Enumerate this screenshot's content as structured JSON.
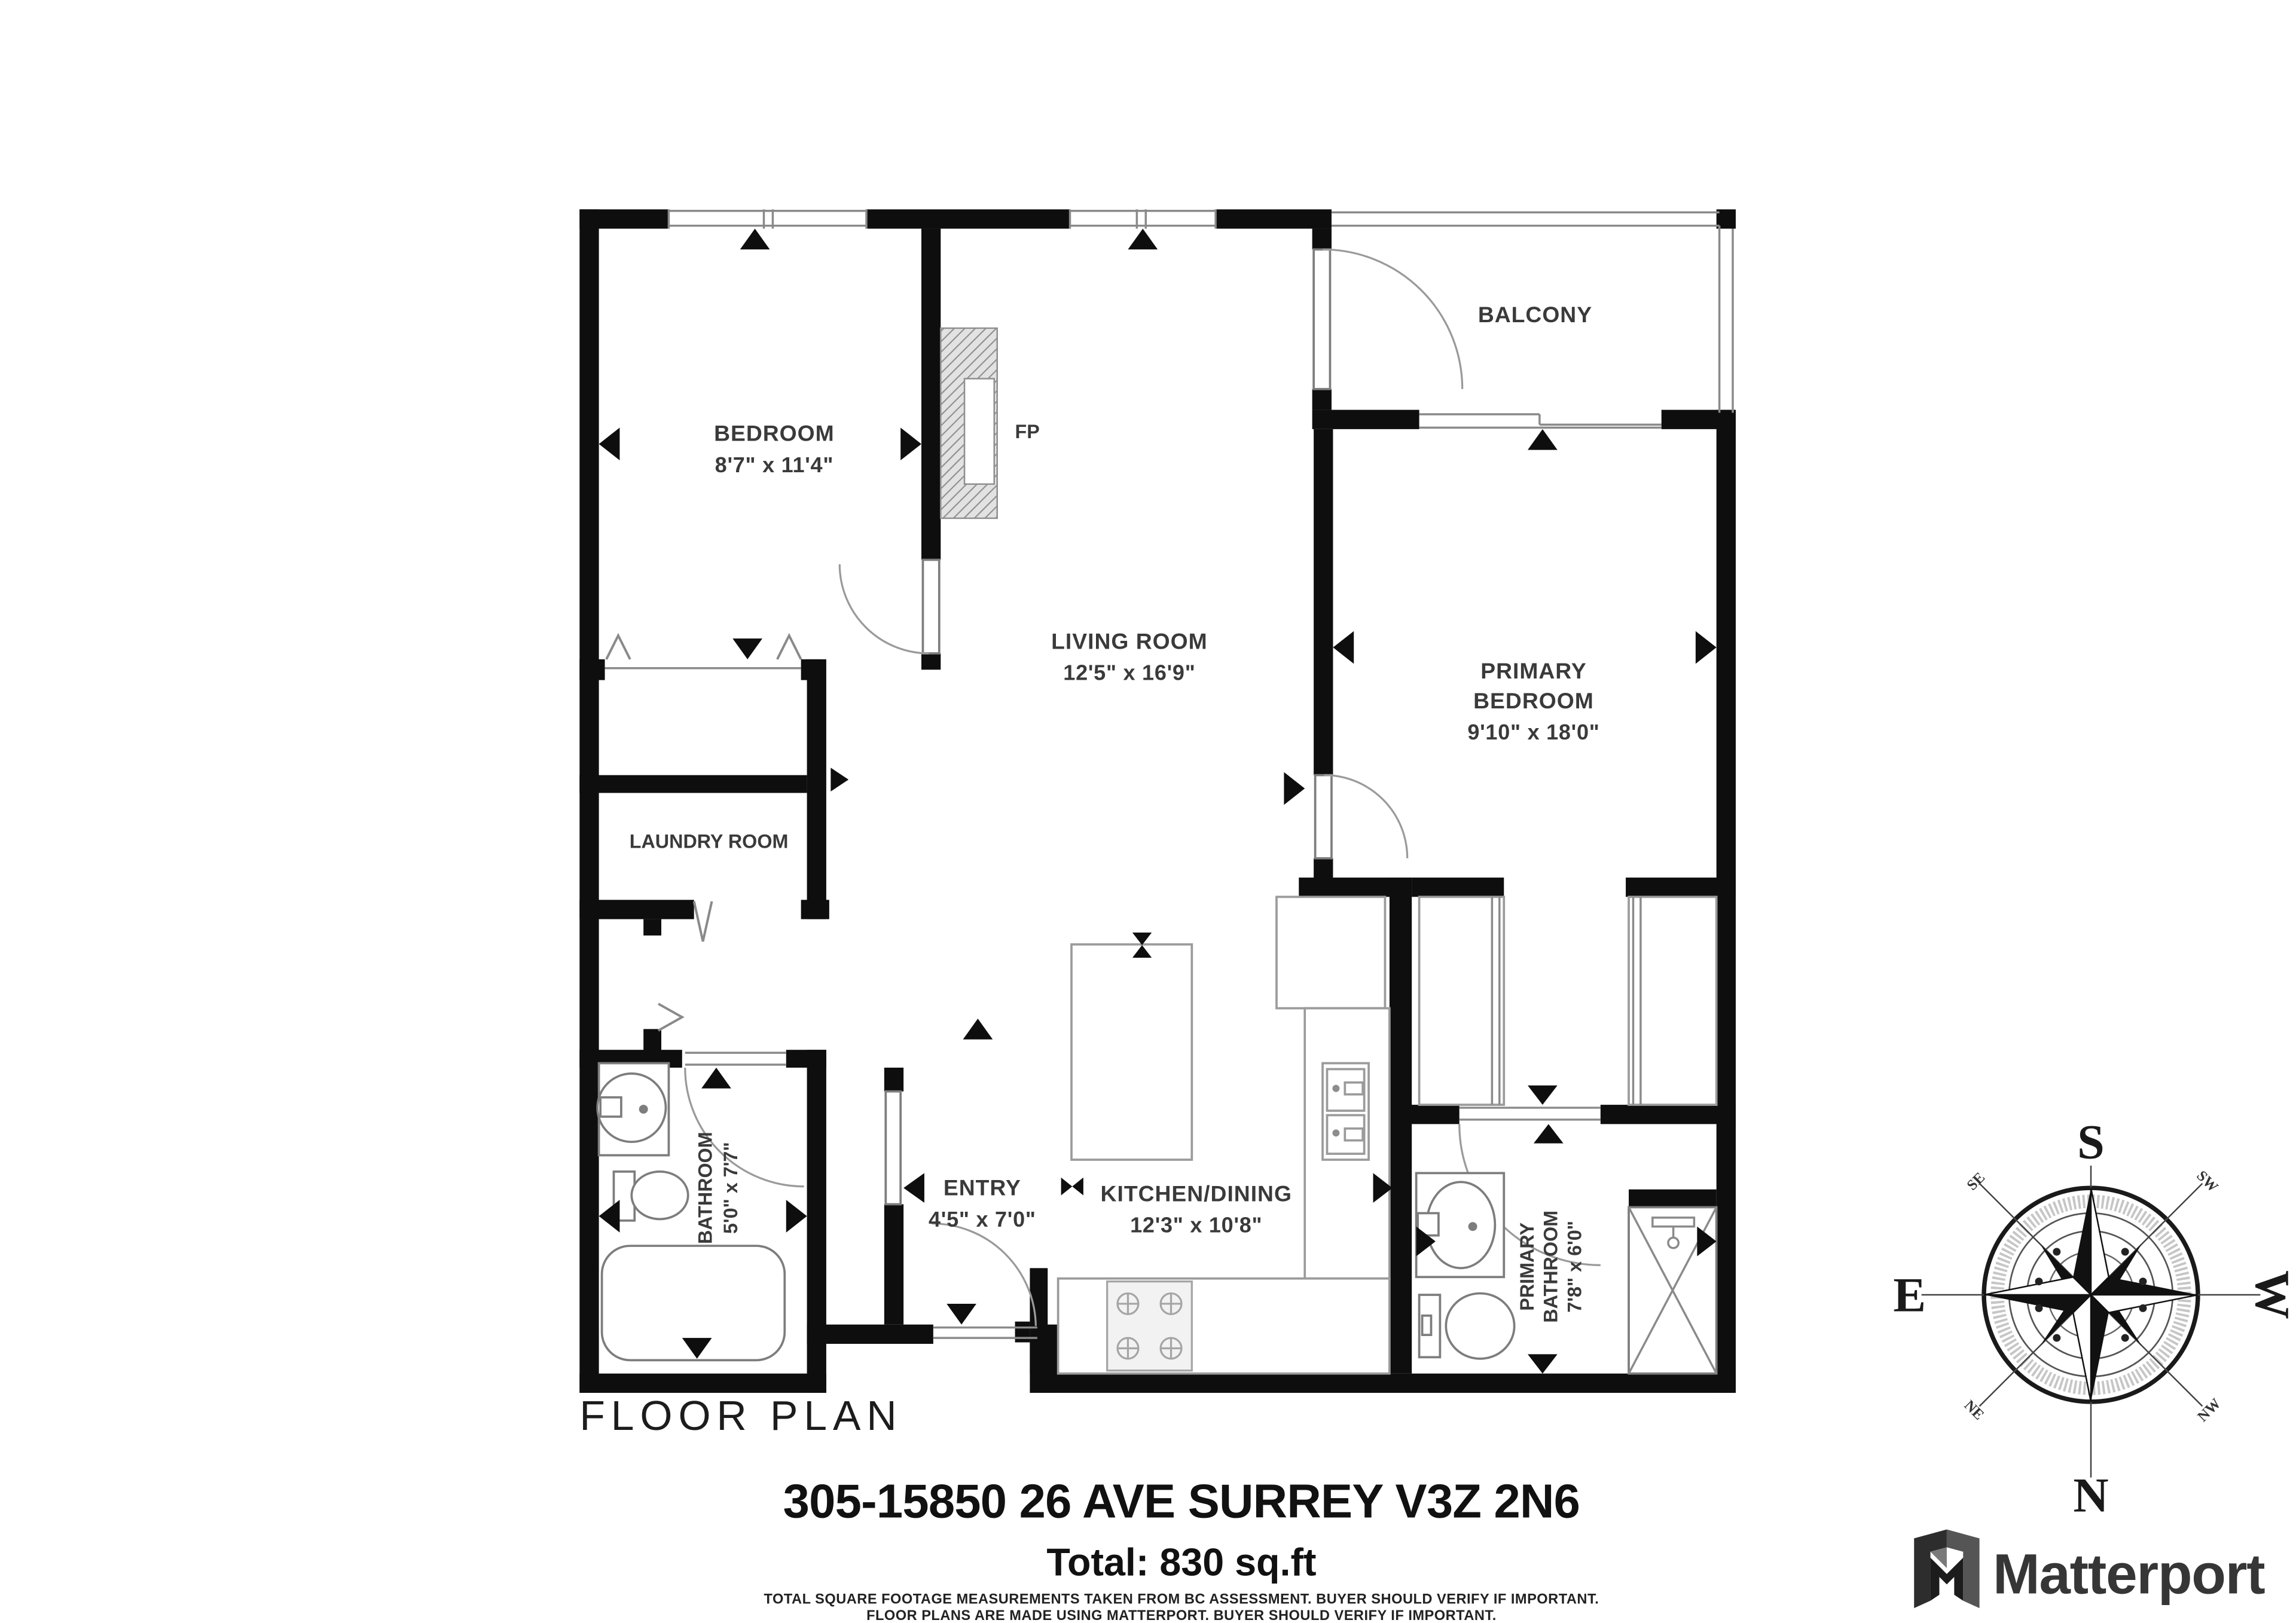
{
  "labels": {
    "floor_plan": "FLOOR PLAN"
  },
  "rooms": {
    "bedroom": {
      "name": "BEDROOM",
      "dims": "8'7\" x 11'4\""
    },
    "living_room": {
      "name": "LIVING ROOM",
      "dims": "12'5\" x 16'9\""
    },
    "primary_bedroom": {
      "name_line1": "PRIMARY",
      "name_line2": "BEDROOM",
      "dims": "9'10\" x 18'0\""
    },
    "balcony": {
      "name": "BALCONY"
    },
    "laundry_room": {
      "name": "LAUNDRY ROOM"
    },
    "bathroom": {
      "name": "BATHROOM",
      "dims": "5'0\" x 7'7\""
    },
    "entry": {
      "name": "ENTRY",
      "dims": "4'5\" x 7'0\""
    },
    "kitchen_dining": {
      "name": "KITCHEN/DINING",
      "dims": "12'3\" x 10'8\""
    },
    "primary_bathroom": {
      "name_line1": "PRIMARY",
      "name_line2": "BATHROOM",
      "dims": "7'8\" x 6'0\""
    },
    "fireplace": {
      "abbr": "FP"
    }
  },
  "footer": {
    "address": "305-15850 26 AVE SURREY V3Z 2N6",
    "total": "Total: 830 sq.ft",
    "disclaimer_line1": "TOTAL SQUARE FOOTAGE MEASUREMENTS TAKEN FROM BC ASSESSMENT. BUYER SHOULD VERIFY IF IMPORTANT.",
    "disclaimer_line2": "FLOOR PLANS ARE MADE USING MATTERPORT. BUYER SHOULD VERIFY IF IMPORTANT."
  },
  "compass": {
    "south": "S",
    "north": "N",
    "east": "E",
    "west": "W",
    "southeast": "SE",
    "southwest": "SW",
    "northeast": "NE",
    "northwest": "NW"
  },
  "branding": {
    "wordmark": "Matterport"
  },
  "colors": {
    "wall": "#0e0e0e",
    "label": "#3a3a3a",
    "thin_line": "#8a8a8a"
  }
}
